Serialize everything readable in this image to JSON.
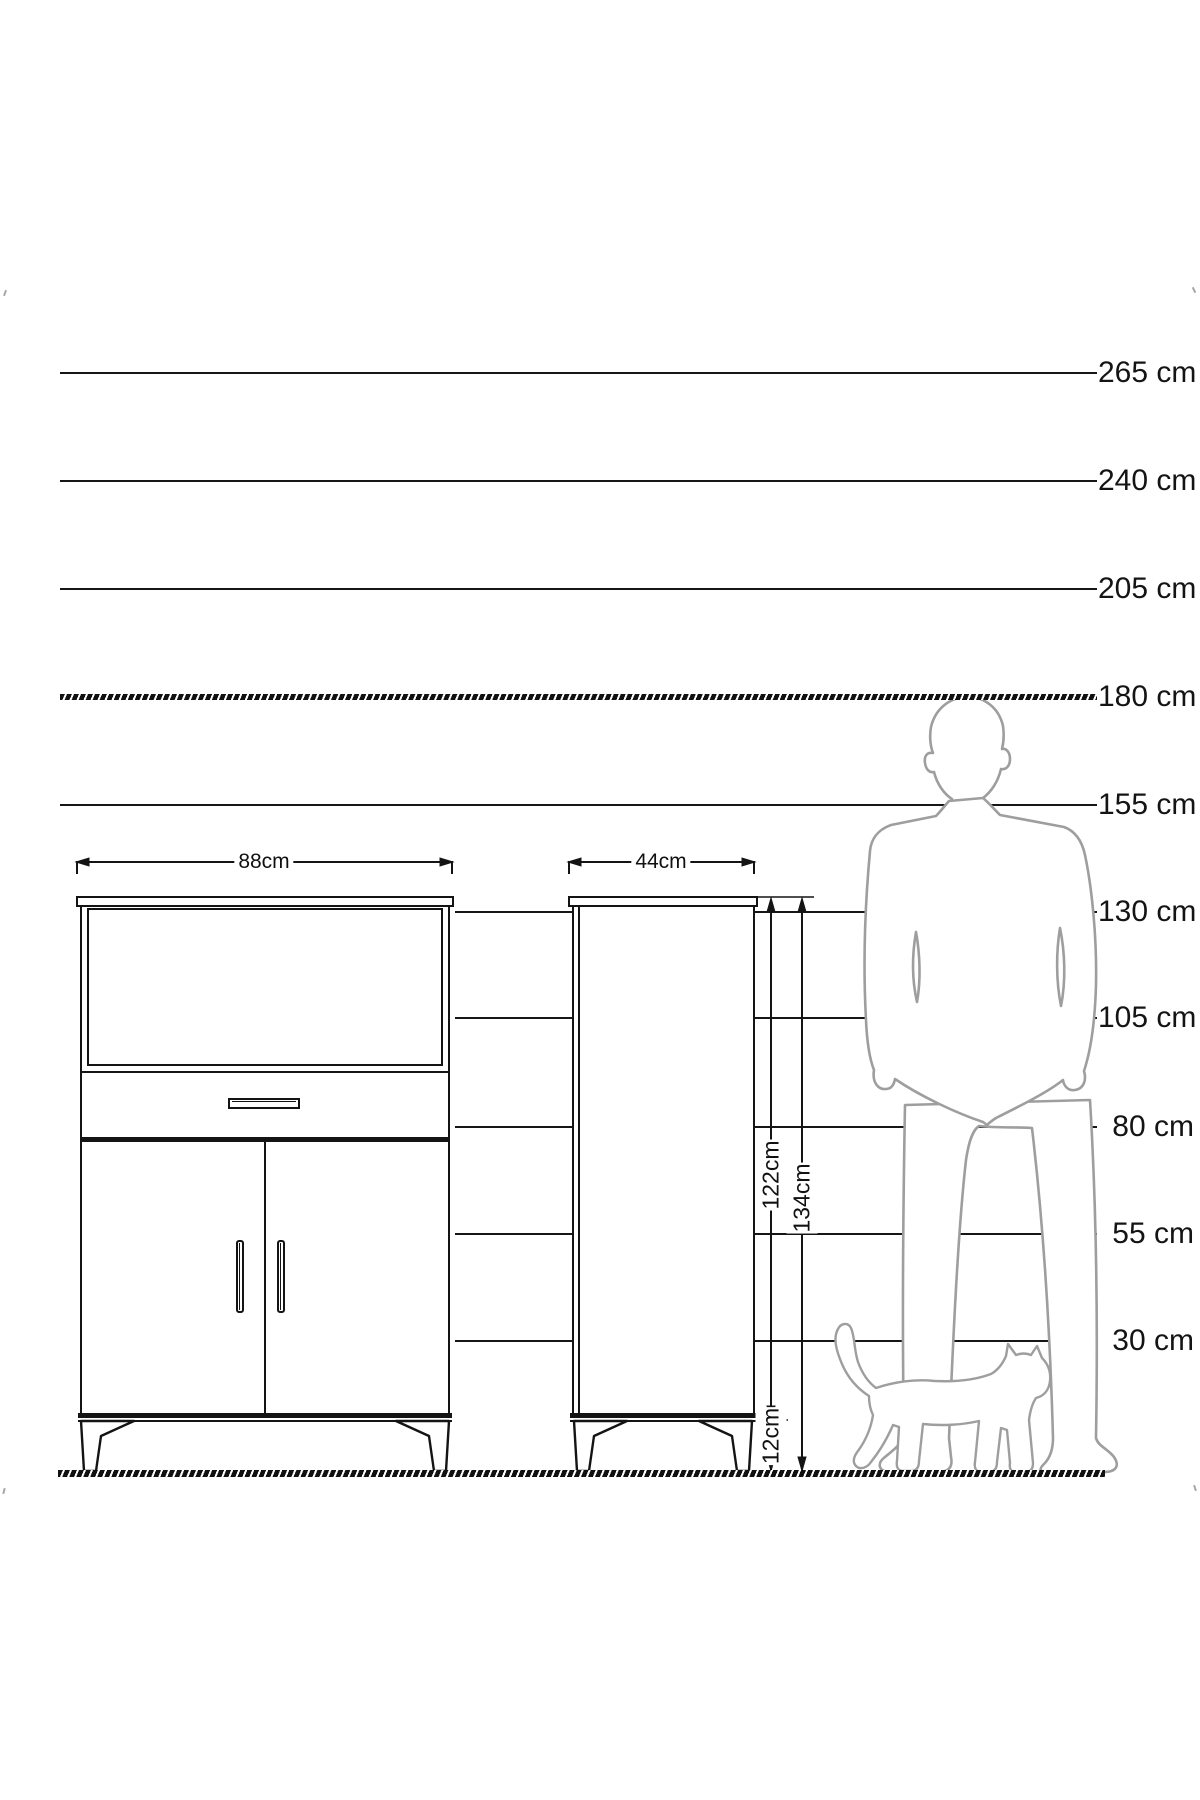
{
  "scale": {
    "labels": [
      "265 cm",
      "240 cm",
      "205 cm",
      "180 cm",
      "155 cm",
      "130 cm",
      "105 cm",
      "80 cm",
      "55 cm",
      "30 cm"
    ]
  },
  "dimensions": {
    "large_cabinet_width": "88cm",
    "small_cabinet_width": "44cm",
    "small_cabinet_body_height": "122cm",
    "small_cabinet_total_height": "134cm",
    "leg_height": "12cm"
  },
  "icons": {
    "man": "standing-man-silhouette",
    "cat": "walking-cat-silhouette"
  },
  "colors": {
    "ink": "#141414",
    "silhouette_outline": "#9e9e9e",
    "background": "#ffffff"
  }
}
